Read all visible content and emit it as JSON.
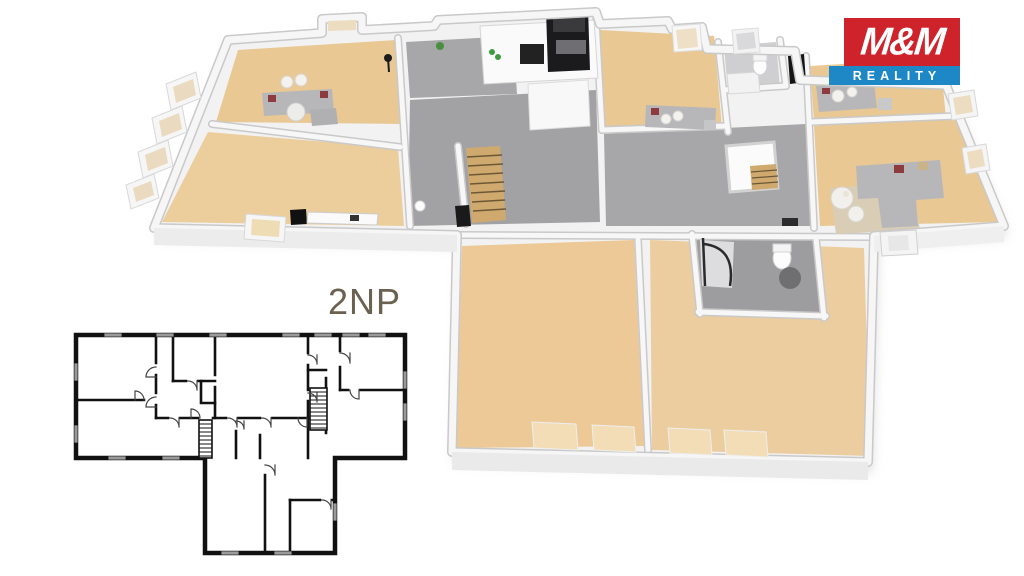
{
  "page": {
    "background": "#ffffff"
  },
  "logo": {
    "title": "M&M",
    "subtitle": "REALITY",
    "colors": {
      "red": "#cf232b",
      "blue": "#1e87c5",
      "text": "#ffffff"
    }
  },
  "floor_plan": {
    "label": "2NP",
    "label_color": "#6a6150",
    "colors": {
      "wood_floor": "#e9c894",
      "wood_light": "#f2debb",
      "tile_gray": "#a7a7a9",
      "bath_tile": "#9d9d9f",
      "wall_white": "#f6f6f6",
      "wall_edge": "#cccccc",
      "plan_line": "#111111",
      "sofa_gray": "#b7b7b9",
      "accent_pillow": "#8e3b40",
      "stair_wood": "#cfa96e",
      "rug_beige": "#d9cdb6",
      "appliance_black": "#1b1b1d"
    }
  }
}
